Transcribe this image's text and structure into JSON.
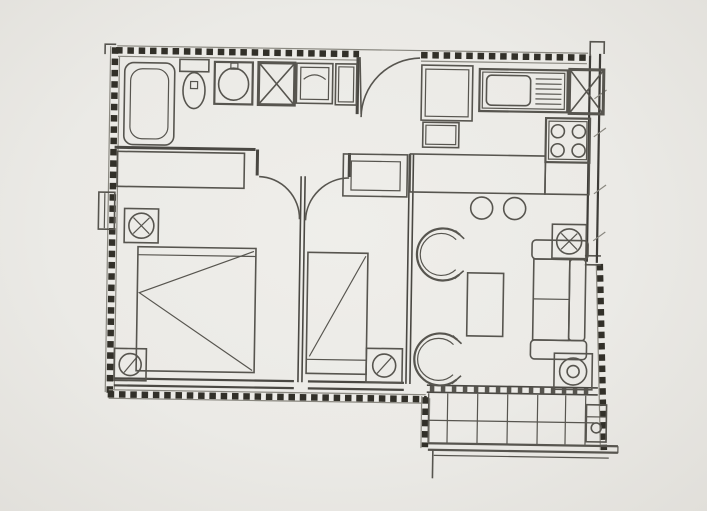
{
  "meta": {
    "description": "Scanned architectural floor plan of a small apartment (two rooms, bathroom, kitchen/living area and balcony); monochrome line drawing on grey photographed paper, no visible text labels",
    "visible_text": ""
  },
  "colors": {
    "paper": "#edece8",
    "paper_edge": "#e1dfda",
    "line": "#57554f",
    "line_light": "#8a8880",
    "wall": "#3e3c38",
    "wall_dash": "#323029"
  },
  "plan": {
    "rooms": [
      "bathroom",
      "entry-hall",
      "kitchen",
      "living-room",
      "bedroom-1",
      "bedroom-2",
      "balcony"
    ],
    "fixtures": [
      "bathtub",
      "toilet",
      "washbasin",
      "ventilation-shaft",
      "washing-machine",
      "bathroom-cabinet",
      "entry-closet",
      "kitchen-sink",
      "kitchen-shaft",
      "stove-4-burners",
      "kitchen-bar-counter",
      "bar-stools",
      "double-bed",
      "single-bed",
      "wardrobe",
      "round-chair",
      "coffee-table",
      "sofa",
      "equipment-symbol",
      "balcony-railing",
      "balcony-unit",
      "window-band",
      "door-swing-arc"
    ]
  }
}
